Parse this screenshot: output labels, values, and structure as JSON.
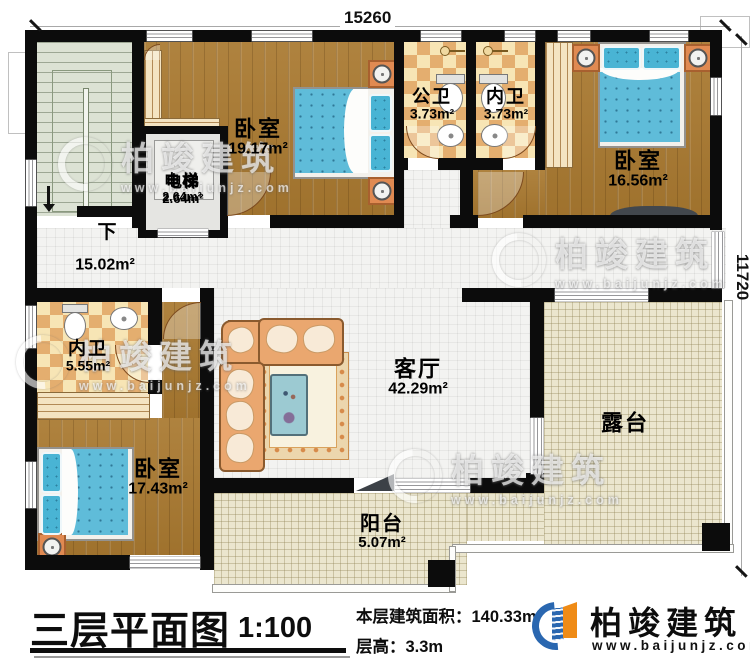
{
  "dimensions": {
    "width_top": "15260",
    "height_right": "11720"
  },
  "stairs": {
    "direction_label": "下"
  },
  "rooms": {
    "bedroom_tl": {
      "name": "卧室",
      "area": "19.17m²"
    },
    "elevator": {
      "name": "电梯",
      "area": "2.64m²"
    },
    "public_bath": {
      "name": "公卫",
      "area": "3.73m²"
    },
    "ensuite_bath_top": {
      "name": "内卫",
      "area": "3.73m²"
    },
    "bedroom_tr": {
      "name": "卧室",
      "area": "16.56m²"
    },
    "hallway": {
      "area": "15.02m²"
    },
    "ensuite_bath_left": {
      "name": "内卫",
      "area": "5.55m²"
    },
    "bedroom_bl": {
      "name": "卧室",
      "area": "17.43m²"
    },
    "living_room": {
      "name": "客厅",
      "area": "42.29m²"
    },
    "terrace": {
      "name": "露台"
    },
    "balcony": {
      "name": "阳台",
      "area": "5.07m²"
    }
  },
  "title_block": {
    "title": "三层平面图",
    "scale": "1:100",
    "floor_area_label": "本层建筑面积：140.33m²",
    "floor_height_label": "层高：3.3m"
  },
  "brand": {
    "name": "柏竣建筑",
    "website": "www.baijunjz.com"
  },
  "colors": {
    "wall": "#0c0c0c",
    "wood_floor": "#a97930",
    "tile_check_dark": "#e4ae6f",
    "tile_check_light": "#f7e5b5",
    "outdoor_floor": "#ebe6ce",
    "bed_blue": "#5fbcd9",
    "furniture_orange": "#e08a52",
    "brand_blue": "#2a67b0",
    "brand_orange": "#ef8b16"
  }
}
